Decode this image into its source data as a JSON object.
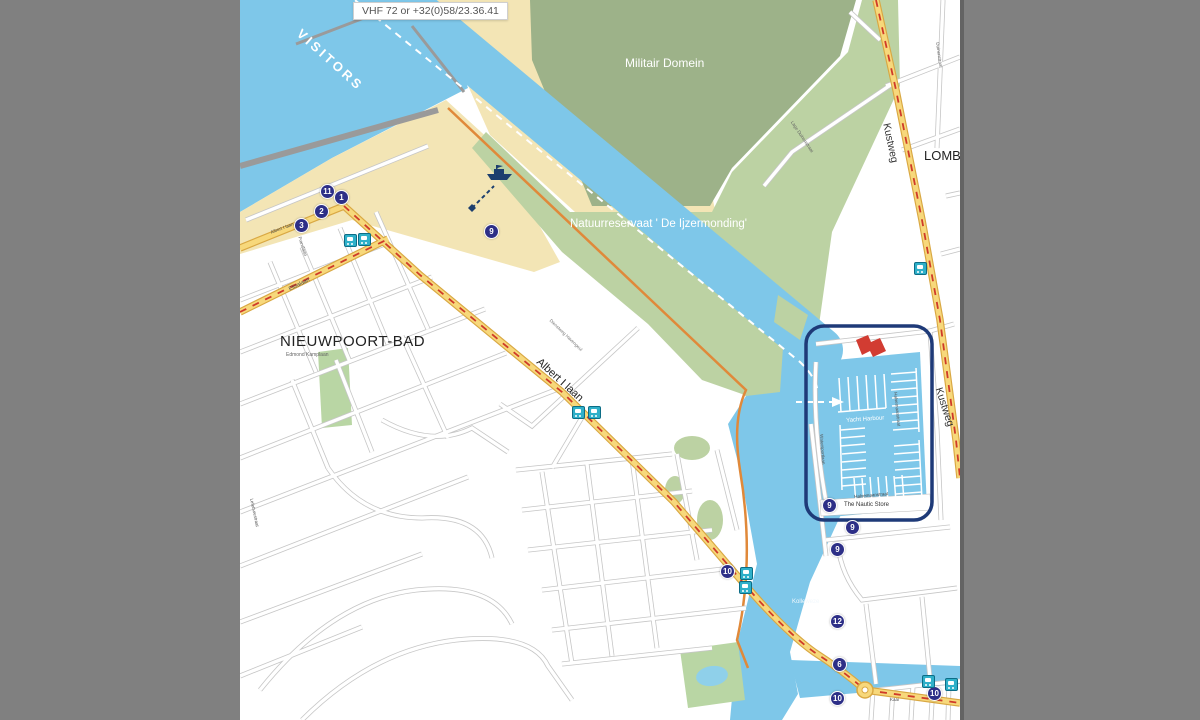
{
  "header": {
    "vhf_label": "VHF 72 or +32(0)58/23.36.41"
  },
  "map": {
    "labels": {
      "visitors": "VISITORS",
      "militair_domein": "Militair Domein",
      "natuurreservaat": "Natuurreservaat ' De Ijzermonding'",
      "town": "NIEUWPOORT-BAD",
      "town_side_street": "Edmond Kamplaan",
      "lombardsijde": "LOMBARDSIJDE",
      "kustweg": "Kustweg",
      "albert_laan": "Albert I laan",
      "elisalaan": "Elisalaan",
      "franslaan": "Franslaan",
      "lefebvrestraat": "Lefebvrestraat",
      "dienstweg": "Dienstweg Havengeul",
      "lage_duinenstraat": "Lage Duinenstraat",
      "duinenstraat": "Duinenstraat",
      "halvemaanstraat": "Halvemaanstraat",
      "watersportlaan": "Watersportlaan",
      "yacht_harbour": "Yacht Harbour",
      "nautic_store": "The Nautic Store",
      "kolleweze": "Kolleweze",
      "kaai": "Kaai"
    },
    "badges": [
      {
        "n": "11"
      },
      {
        "n": "1"
      },
      {
        "n": "2"
      },
      {
        "n": "3"
      },
      {
        "n": "9"
      },
      {
        "n": "9"
      },
      {
        "n": "9"
      },
      {
        "n": "9"
      },
      {
        "n": "10"
      },
      {
        "n": "12"
      },
      {
        "n": "6"
      },
      {
        "n": "10"
      },
      {
        "n": "10"
      }
    ],
    "colors": {
      "water": "#7ec7e9",
      "sand": "#f3e5b5",
      "green_light": "#bcd2a3",
      "green_dark": "#9db289",
      "road_yellow": "#f7d87b",
      "road_casing": "#d9a843",
      "street_casing": "#c6c6c6",
      "tram_red": "#cf3a2a",
      "badge_navy": "#2d2f87",
      "tram_stop_teal": "#2fb0c9",
      "marina_outline": "#1e3a78",
      "building_red": "#d23c32",
      "dike_orange": "#e0893a",
      "frame_gray": "#808080"
    }
  }
}
